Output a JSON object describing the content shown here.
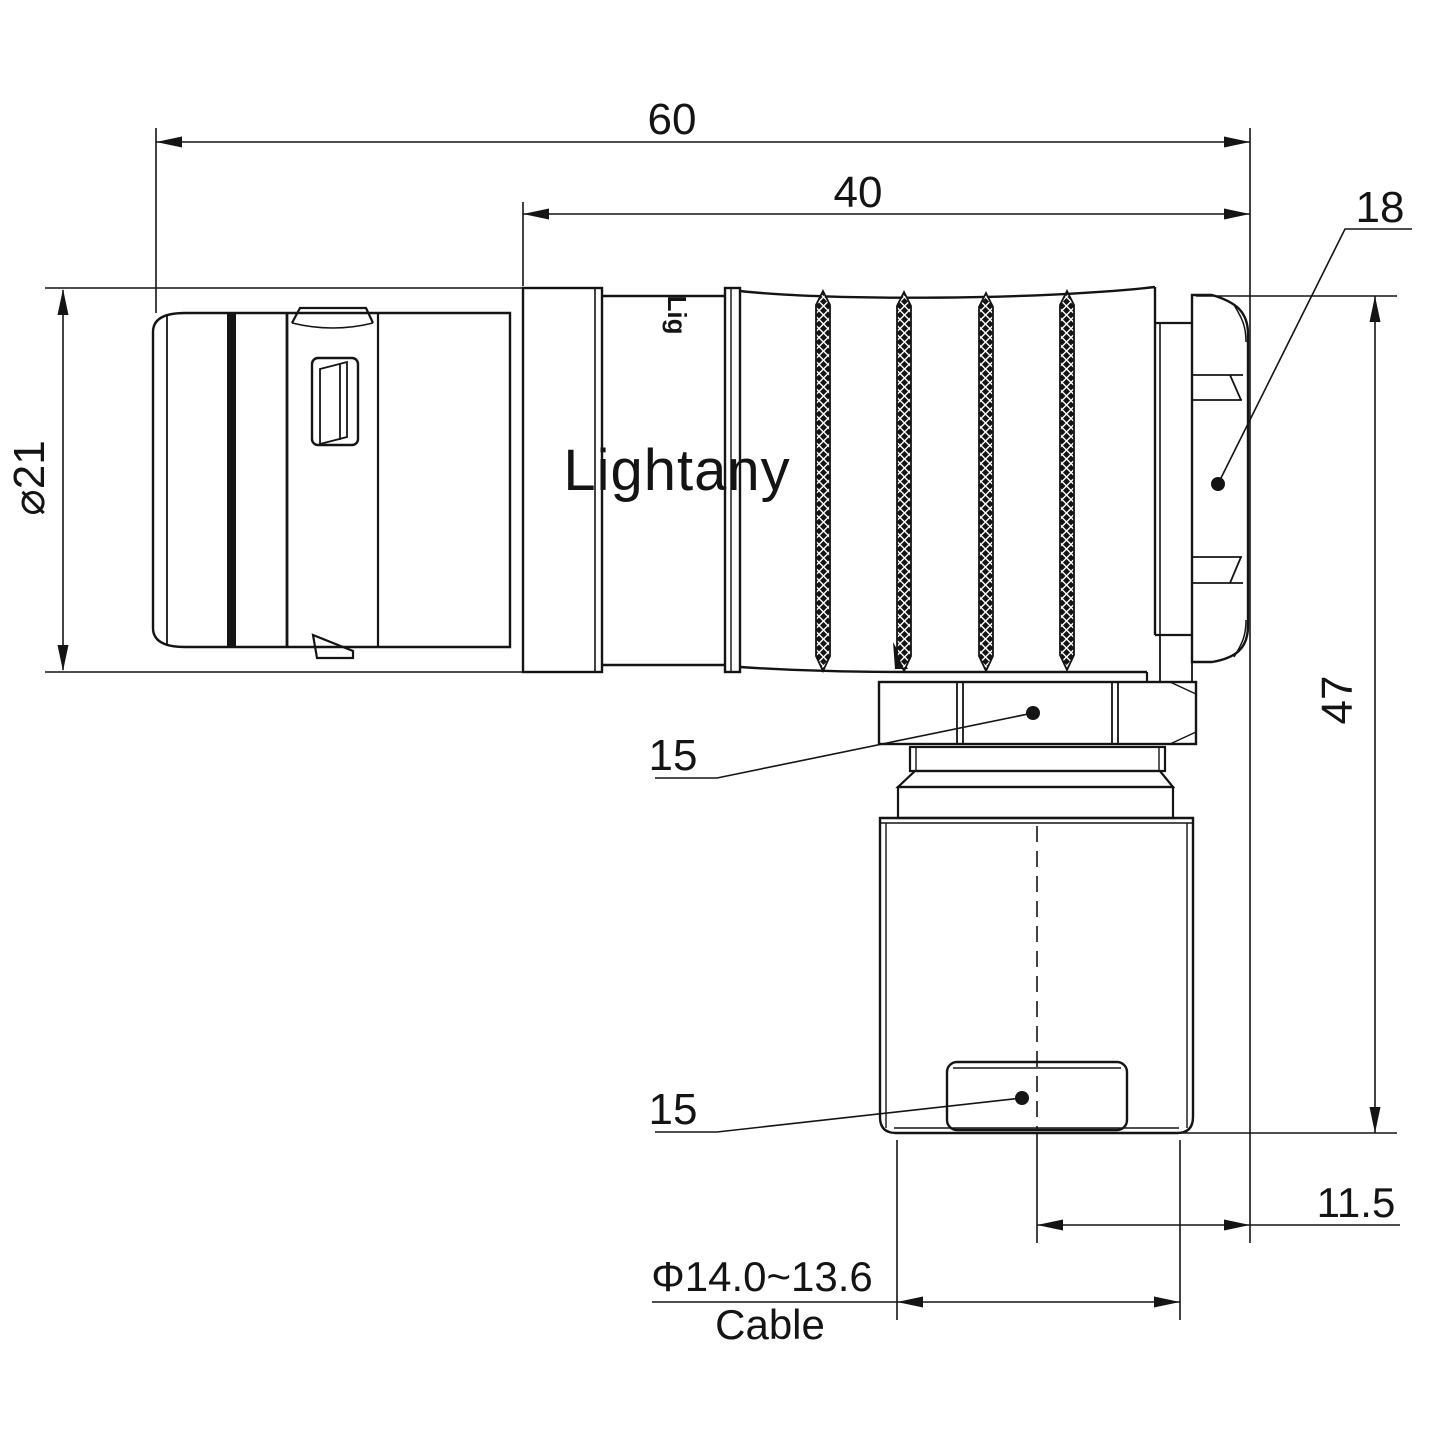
{
  "page": {
    "background": "#ffffff"
  },
  "drawing": {
    "line_color": "#141414",
    "watermark": {
      "text": "Lightany",
      "color": "#f6c8c3"
    },
    "shell_marking": "Lig",
    "dimensions": {
      "overall_length": "60",
      "shell_length": "40",
      "back_nut": "18",
      "front_diameter": "⌀21",
      "overall_height": "47",
      "coupling_nut_width": "15",
      "cable_clamp_width": "15",
      "exit_offset": "11.5",
      "cable_diameter": "Φ14.0~13.6",
      "cable_label": "Cable"
    }
  }
}
